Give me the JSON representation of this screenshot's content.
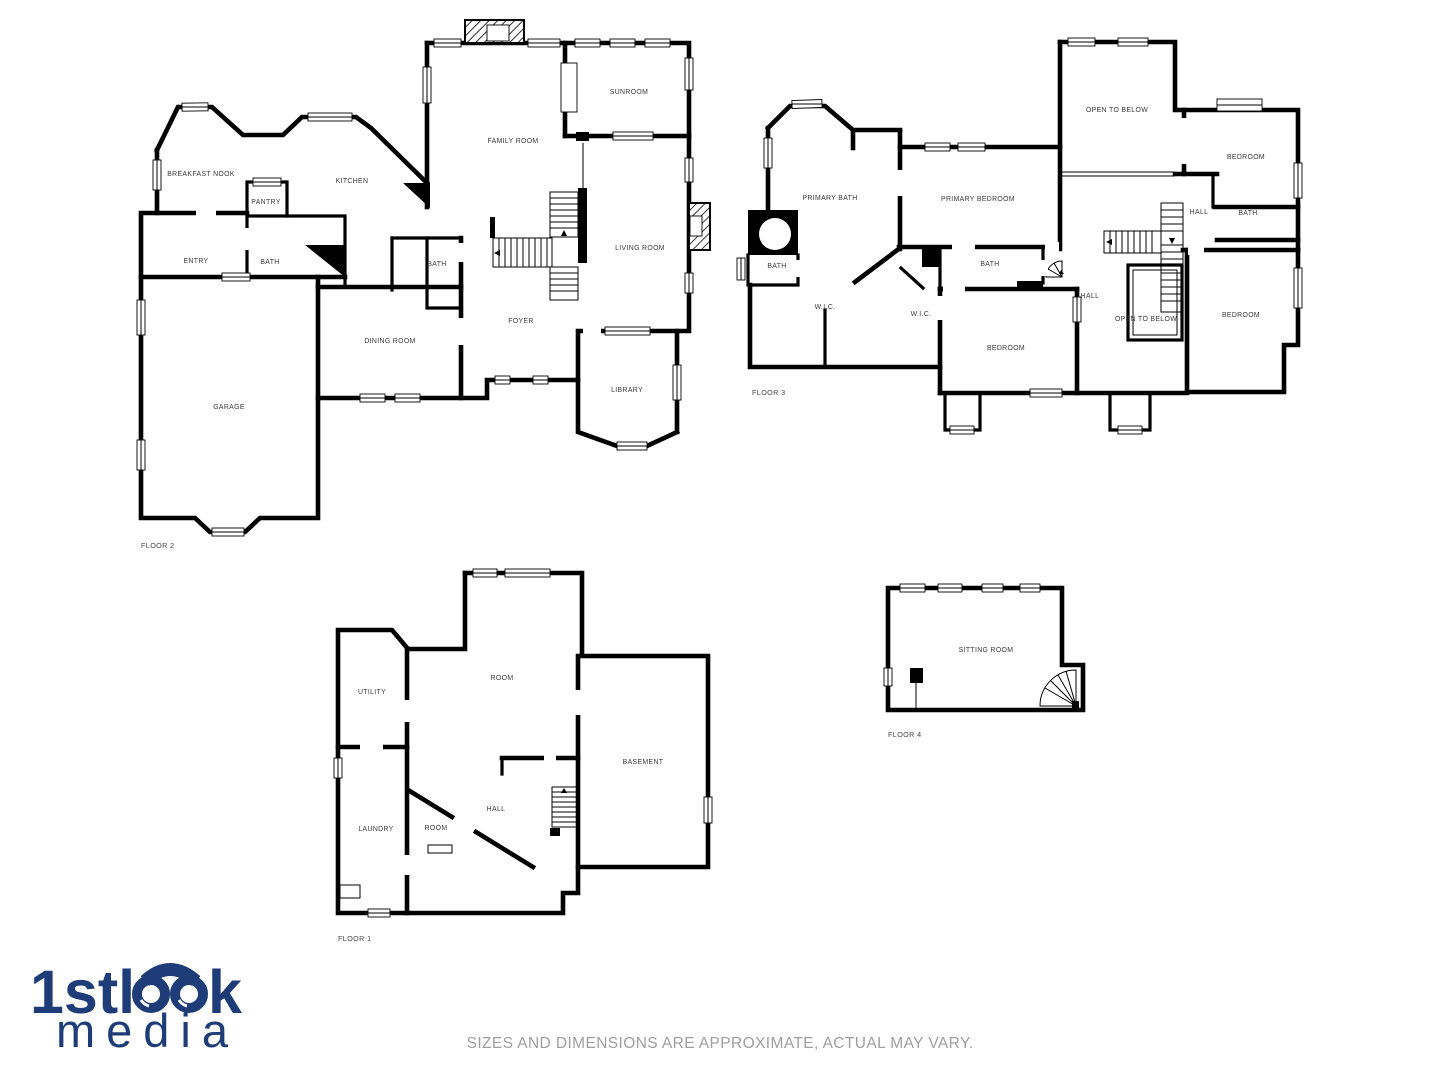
{
  "floor2": {
    "name": "FLOOR 2",
    "breakfast_nook": "BREAKFAST NOOK",
    "kitchen": "KITCHEN",
    "pantry": "PANTRY",
    "entry": "ENTRY",
    "bath_a": "BATH",
    "bath_b": "BATH",
    "family_room": "FAMILY ROOM",
    "sunroom": "SUNROOM",
    "living_room": "LIVING ROOM",
    "foyer": "FOYER",
    "dining_room": "DINING ROOM",
    "garage": "GARAGE",
    "library": "LIBRARY"
  },
  "floor3": {
    "name": "FLOOR 3",
    "primary_bath": "PRIMARY BATH",
    "primary_bedroom": "PRIMARY BEDROOM",
    "open_to_below_upper": "OPEN TO BELOW",
    "bedroom_top_right": "BEDROOM",
    "hall_upper": "HALL",
    "bath_right": "BATH",
    "bath_left": "BATH",
    "wic_left": "W.I.C.",
    "wic_mid": "W.I.C.",
    "bath_mid": "BATH",
    "bedroom_mid": "BEDROOM",
    "hall_mid": "HALL",
    "open_to_below_lower": "OPEN TO BELOW",
    "bedroom_bottom_right": "BEDROOM"
  },
  "floor1": {
    "name": "FLOOR 1",
    "room_upper": "ROOM",
    "utility": "UTILITY",
    "laundry": "LAUNDRY",
    "room_lower": "ROOM",
    "hall": "HALL",
    "basement": "BASEMENT"
  },
  "floor4": {
    "name": "FLOOR 4",
    "sitting_room": "SITTING ROOM"
  },
  "logo": {
    "part1": "1stl",
    "part2": "k",
    "line2": "media",
    "brand_color": "#1e3c78"
  },
  "colors": {
    "walls": "#000000",
    "labels": "#3a3a3a",
    "disclaimer_text": "#9e9e9e"
  },
  "disclaimer": "SIZES AND DIMENSIONS ARE APPROXIMATE, ACTUAL MAY VARY."
}
